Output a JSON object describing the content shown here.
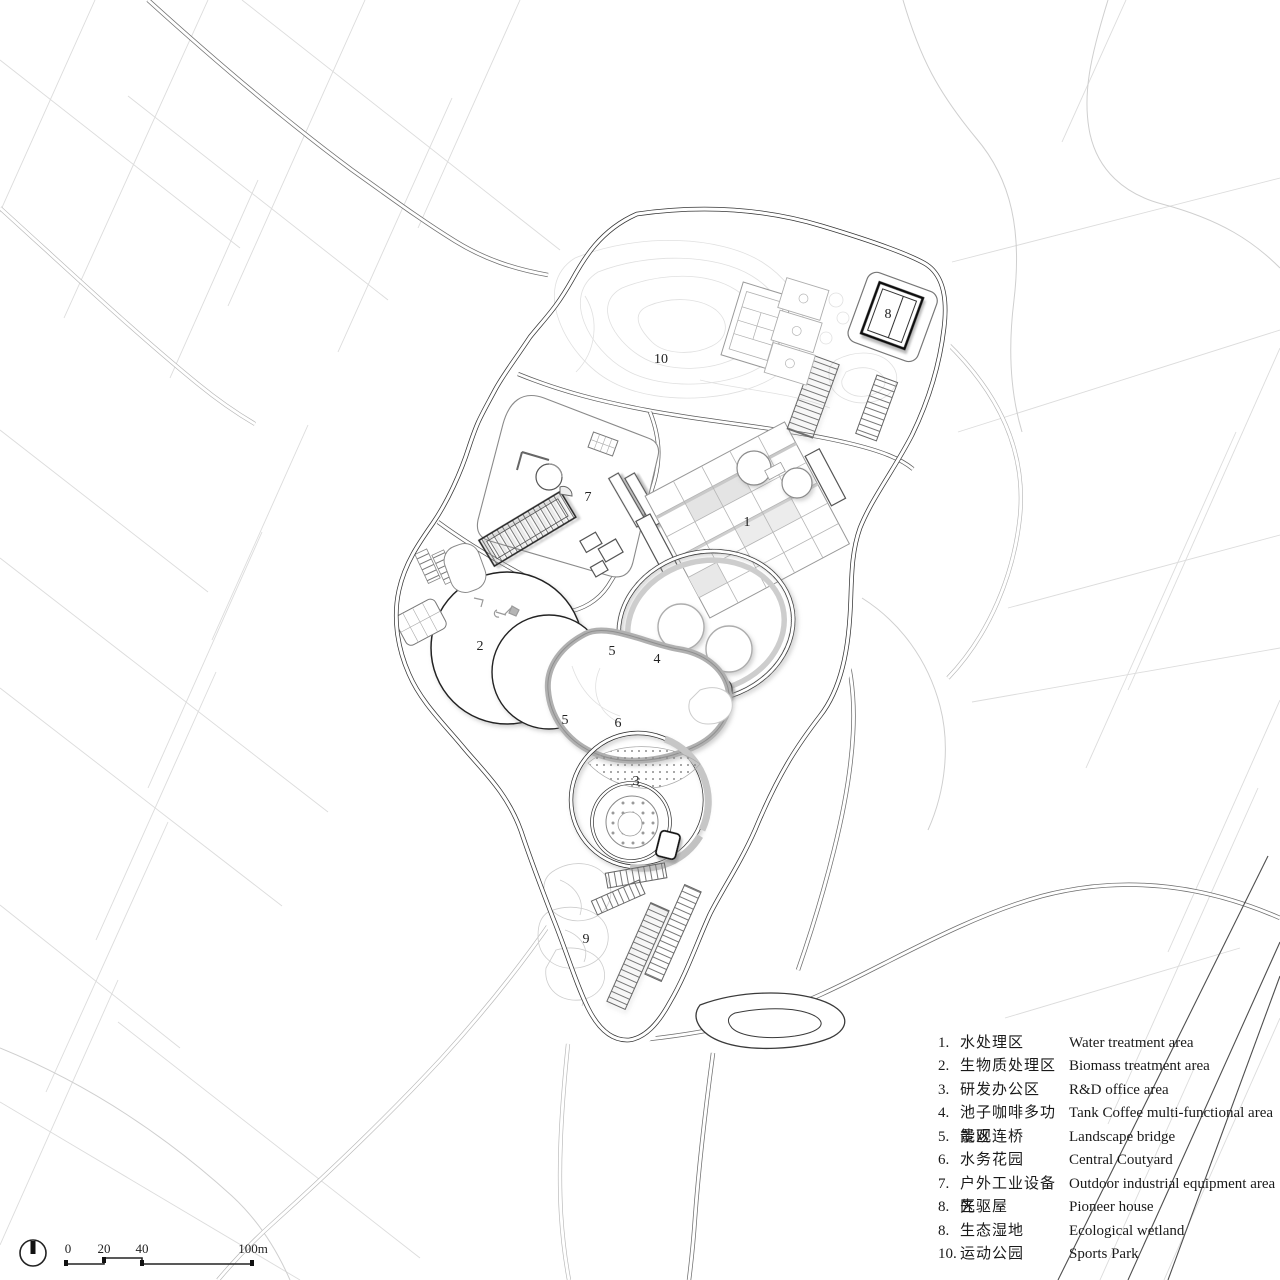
{
  "plan": {
    "labels": [
      {
        "text": "1"
      },
      {
        "text": "2"
      },
      {
        "text": "3"
      },
      {
        "text": "4"
      },
      {
        "text": "5"
      },
      {
        "text": "5"
      },
      {
        "text": "6"
      },
      {
        "text": "7"
      },
      {
        "text": "8"
      },
      {
        "text": "9"
      },
      {
        "text": "10"
      }
    ]
  },
  "legend": {
    "items": [
      {
        "n": "1.",
        "zh": "水处理区",
        "en": "Water treatment area"
      },
      {
        "n": "2.",
        "zh": "生物质处理区",
        "en": "Biomass treatment area"
      },
      {
        "n": "3.",
        "zh": "研发办公区",
        "en": "R&D office area"
      },
      {
        "n": "4.",
        "zh": "池子咖啡多功能区",
        "en": "Tank Coffee multi-functional area"
      },
      {
        "n": "5.",
        "zh": "景观连桥",
        "en": "Landscape bridge"
      },
      {
        "n": "6.",
        "zh": "水务花园",
        "en": "Central Coutyard"
      },
      {
        "n": "7.",
        "zh": "户外工业设备区",
        "en": "Outdoor industrial equipment area"
      },
      {
        "n": "8.",
        "zh": "先驱屋",
        "en": "Pioneer house"
      },
      {
        "n": "8.",
        "zh": "生态湿地",
        "en": "Ecological wetland"
      },
      {
        "n": "10.",
        "zh": "运动公园",
        "en": "Sports Park"
      }
    ]
  },
  "scalebar": {
    "ticks": [
      "0",
      "20",
      "40",
      "100m"
    ]
  },
  "colors": {
    "ink": "#2f2f2f",
    "context_line": "#dcdcdc",
    "shadow": "#8f8f8f",
    "paper": "#ffffff"
  }
}
